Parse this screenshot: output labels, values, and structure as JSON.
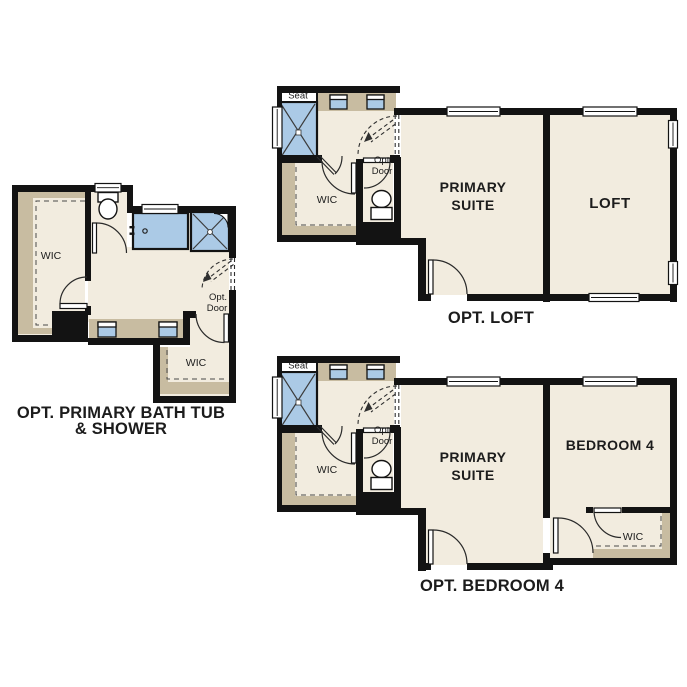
{
  "colors": {
    "floor": "#f2ecdf",
    "band": "#c8bca1",
    "fixture": "#abcae6",
    "wall": "#131313",
    "ink": "#1c1c1c"
  },
  "bath_plan": {
    "caption_line1": "OPT. PRIMARY BATH TUB",
    "caption_line2": "& SHOWER",
    "wic_left": "WIC",
    "wic_bottom": "WIC",
    "opt_door_line1": "Opt.",
    "opt_door_line2": "Door"
  },
  "bathroom_block": {
    "seat": "Seat",
    "wic": "WIC",
    "opt_door_line1": "Opt.",
    "opt_door_line2": "Door"
  },
  "loft_plan": {
    "caption": "OPT. LOFT",
    "primary_line1": "PRIMARY",
    "primary_line2": "SUITE",
    "loft": "LOFT"
  },
  "bedroom4_plan": {
    "caption": "OPT. BEDROOM 4",
    "primary_line1": "PRIMARY",
    "primary_line2": "SUITE",
    "bedroom": "BEDROOM 4",
    "wic": "WIC",
    "opt_door_line1": "Opt.",
    "opt_door_line2": "Door"
  }
}
